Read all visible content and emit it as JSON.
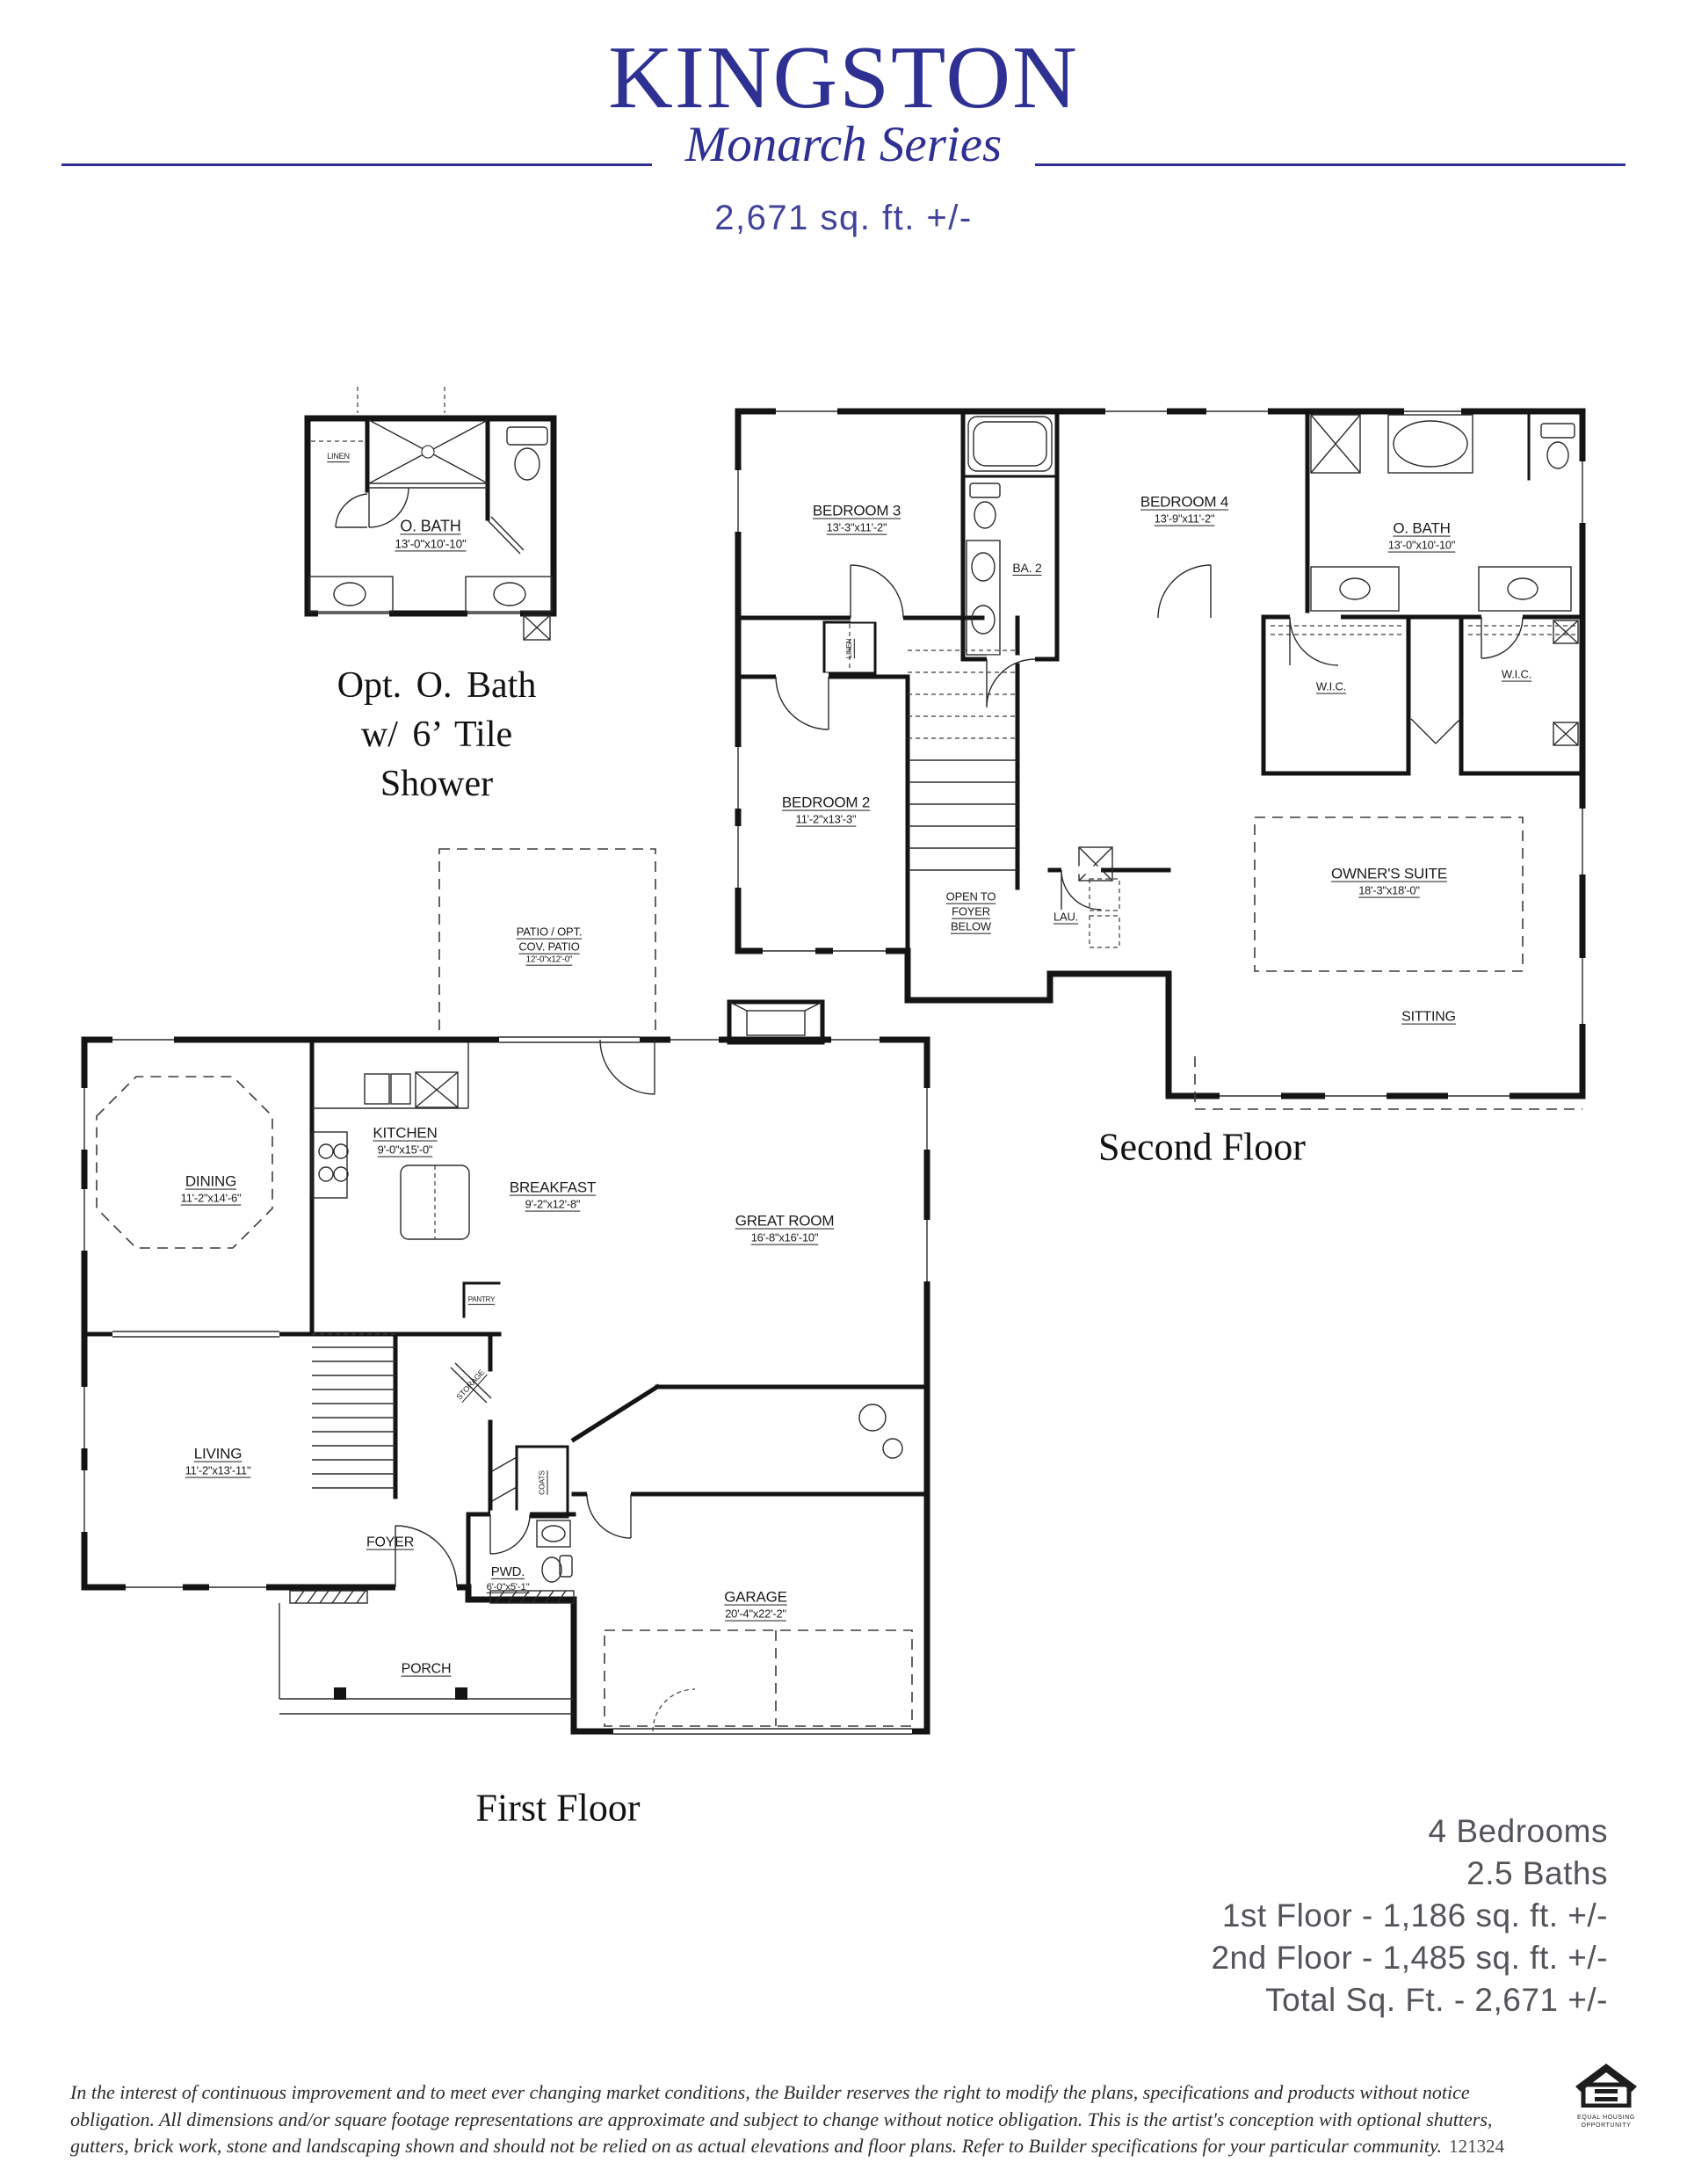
{
  "header": {
    "title": "KINGSTON",
    "series": "Monarch Series",
    "sqft": "2,671 sq. ft. +/-"
  },
  "colors": {
    "brand_navy": "#2e3092",
    "sqft_blue": "#41429a",
    "summary_gray": "#53545a",
    "drawing_ink": "#141414"
  },
  "opt_bath": {
    "caption_line1": "Opt. O. Bath",
    "caption_line2": "w/ 6’ Tile",
    "caption_line3": "Shower",
    "rooms": {
      "linen": "LINEN",
      "obath_name": "O. BATH",
      "obath_dims": "13'-0\"x10'-10\""
    }
  },
  "second_floor": {
    "caption": "Second Floor",
    "rooms": {
      "bedroom3_name": "BEDROOM 3",
      "bedroom3_dims": "13'-3\"x11'-2\"",
      "ba2": "BA. 2",
      "bedroom4_name": "BEDROOM 4",
      "bedroom4_dims": "13'-9\"x11'-2\"",
      "obath_name": "O. BATH",
      "obath_dims": "13'-0\"x10'-10\"",
      "wic_left": "W.I.C.",
      "wic_right": "W.I.C.",
      "bedroom2_name": "BEDROOM 2",
      "bedroom2_dims": "11'-2\"x13'-3\"",
      "linen": "LINEN",
      "open_to_1": "OPEN TO",
      "open_to_2": "FOYER",
      "open_to_3": "BELOW",
      "lau": "LAU.",
      "owners_name": "OWNER'S SUITE",
      "owners_dims": "18'-3\"x18'-0\"",
      "sitting": "SITTING"
    }
  },
  "first_floor": {
    "caption": "First Floor",
    "rooms": {
      "patio_1": "PATIO / OPT.",
      "patio_2": "COV. PATIO",
      "patio_dims": "12'-0\"x12'-0\"",
      "kitchen_name": "KITCHEN",
      "kitchen_dims": "9'-0\"x15'-0\"",
      "dining_name": "DINING",
      "dining_dims": "11'-2\"x14'-6\"",
      "breakfast_name": "BREAKFAST",
      "breakfast_dims": "9'-2\"x12'-8\"",
      "greatroom_name": "GREAT ROOM",
      "greatroom_dims": "16'-8\"x16'-10\"",
      "living_name": "LIVING",
      "living_dims": "11'-2\"x13'-11\"",
      "foyer": "FOYER",
      "pantry": "PANTRY",
      "storage": "STORAGE",
      "coats": "COATS",
      "pwd_name": "PWD.",
      "pwd_dims": "6'-0\"x5'-1\"",
      "porch": "PORCH",
      "garage_name": "GARAGE",
      "garage_dims": "20'-4\"x22'-2\""
    }
  },
  "summary": {
    "lines": [
      "4 Bedrooms",
      "2.5 Baths",
      "1st Floor - 1,186 sq. ft. +/-",
      "2nd Floor - 1,485 sq. ft. +/-",
      "Total Sq. Ft. - 2,671 +/-"
    ]
  },
  "disclaimer": {
    "text": "In the interest of continuous improvement and to meet ever changing market conditions, the Builder reserves the right to modify the plans, specifications and products without notice obligation. All dimensions and/or square footage representations are approximate and subject to change without notice obligation. This is the artist's conception with optional shutters, gutters, brick work, stone and landscaping shown and should not be relied on as actual elevations and floor plans. Refer to Builder specifications for your particular community.",
    "code": "121324"
  },
  "logo": {
    "line1": "EQUAL HOUSING",
    "line2": "OPPORTUNITY"
  }
}
